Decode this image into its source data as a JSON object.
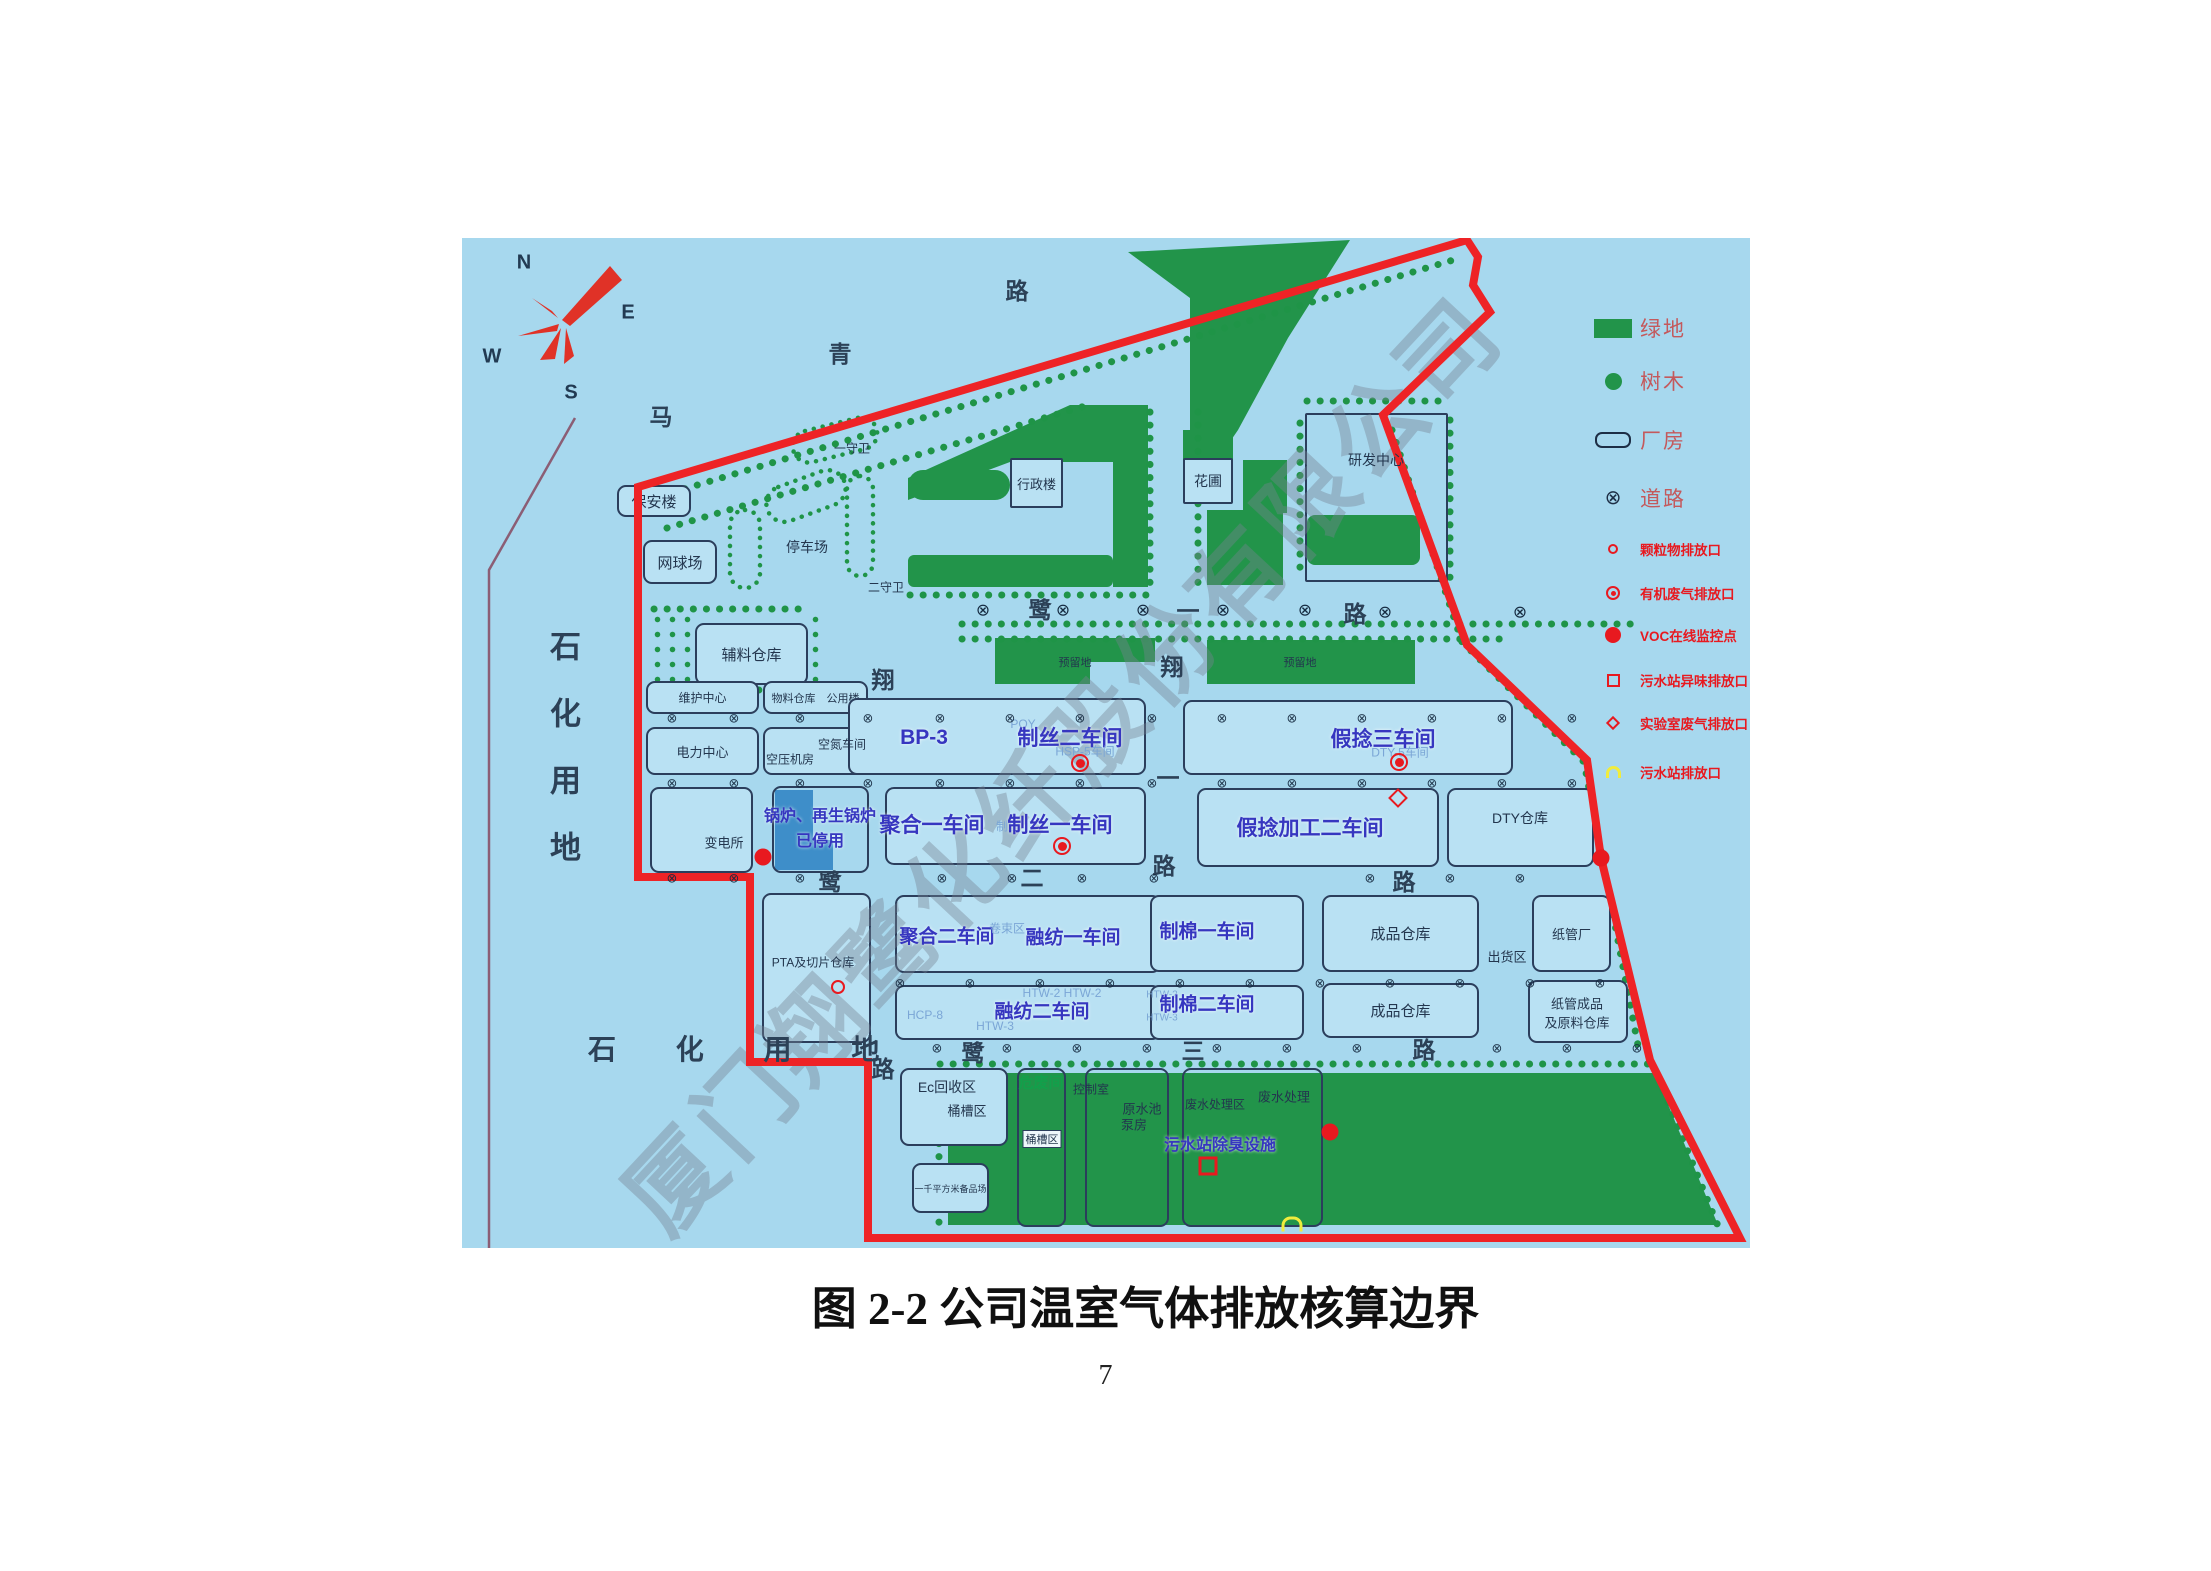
{
  "page": {
    "caption": "图 2-2 公司温室气体排放核算边界",
    "page_number": "7"
  },
  "map": {
    "watermark": "厦门翔鹭化纤股份有限公司",
    "compass": {
      "n": "N",
      "e": "E",
      "s": "S",
      "w": "W"
    },
    "land": {
      "vertical": "石化用地",
      "horizontal": "石 化 用 地"
    },
    "colors": {
      "map_bg": "#a7d8ee",
      "green": "#22944a",
      "boundary_red": "#ee2326",
      "workshop_blue": "#3636c0",
      "legend_pink": "#c4595c",
      "alert_red": "#e8191f",
      "stopped_boiler_blue": "#3e8ec9",
      "outline_navy": "#2b3e5c",
      "petro_line_purple": "#8b5e75"
    },
    "legend": {
      "items": [
        {
          "symbol": "green-area-swatch",
          "label": "绿地"
        },
        {
          "symbol": "tree-icon",
          "label": "树木"
        },
        {
          "symbol": "factory-building-icon",
          "label": "厂房"
        },
        {
          "symbol": "road-icon",
          "label": "道路"
        },
        {
          "symbol": "pm-outlet-icon",
          "label": "颗粒物排放口"
        },
        {
          "symbol": "organic-gas-outlet-icon",
          "label": "有机废气排放口"
        },
        {
          "symbol": "voc-monitor-icon",
          "label": "VOC在线监控点"
        },
        {
          "symbol": "sewage-odor-outlet-icon",
          "label": "污水站异味排放口"
        },
        {
          "symbol": "lab-gas-outlet-icon",
          "label": "实验室废气排放口"
        },
        {
          "symbol": "sewage-outlet-icon",
          "label": "污水站排放口"
        }
      ]
    },
    "labels": {
      "baoanlou": "保安楼",
      "wangqiuchang": "网球场",
      "tingchechang": "停车场",
      "yishouwei": "一守卫",
      "ershouwei": "二守卫",
      "fuliaocangku": "辅料仓库",
      "weihuzhongxin": "维护中心",
      "wuliao_gongyong": "物料仓库　公用楼",
      "dianlizhongxin": "电力中心",
      "kongyajifang": "空压机房",
      "kongdanchejian": "空氮车间",
      "biandiansuo": "变电所",
      "guolu_line1": "锅炉、再生锅炉",
      "guolu_line2": "已停用",
      "bp3": "BP-3",
      "poy": "POY",
      "zhisi2": "制丝二车间",
      "hsp5": "HSP-5车间",
      "jianian3": "假捻三车间",
      "dty5": "DTY-5车间",
      "juhe1": "聚合一车间",
      "zhisi_small": "制丝",
      "zhisi1": "制丝一车间",
      "jianianjiagong2": "假捻加工二车间",
      "dtycangku": "DTY仓库",
      "juhe2": "聚合二车间",
      "juanshuqu": "卷束区",
      "rongfang1": "融纺一车间",
      "zhimian1": "制棉一车间",
      "chengpincangku1": "成品仓库",
      "chuhuoqu": "出货区",
      "zhiguanchang": "纸管厂",
      "hcp8": "HCP-8",
      "htw2x2": "HTW-2  HTW-2",
      "htw3": "HTW-3",
      "rongfang2": "融纺二车间",
      "htw2b": "HTW-2",
      "htw3b": "HTW-3",
      "zhimian2": "制棉二车间",
      "chengpincangku2": "成品仓库",
      "zhiguan_line1": "纸管成品",
      "zhiguan_line2": "及原料仓库",
      "pta": "PTA及切片仓库",
      "ec": "Ec回收区",
      "tongcaoqu1": "桶槽区",
      "beipinchang": "一千平方米备品场",
      "weifeijian": "危废间",
      "tongcaoqu2": "桶槽区",
      "kongzhishi": "控制室",
      "yuanshuichi": "原水池",
      "bengfang": "泵房",
      "feishuichuliqu": "废水处理区",
      "feishuichuli": "废水处理",
      "wushuichuchou": "污水站除臭设施",
      "xingzhenglou": "行政楼",
      "huapu": "花圃",
      "yanfazhongxin": "研发中心",
      "yuliudi1": "预留地",
      "yuliudi2": "预留地"
    },
    "overlays": [
      {
        "cls": "rc",
        "n": "road-name-char",
        "t": "马",
        "x": 199,
        "y": 177
      },
      {
        "cls": "rc",
        "n": "road-name-char",
        "t": "青",
        "x": 378,
        "y": 114
      },
      {
        "cls": "rc",
        "n": "road-name-char",
        "t": "路",
        "x": 555,
        "y": 51
      },
      {
        "cls": "rc",
        "n": "road-name-char",
        "t": "鹭",
        "x": 578,
        "y": 370
      },
      {
        "cls": "rc",
        "n": "road-name-char",
        "t": "一",
        "x": 726,
        "y": 371
      },
      {
        "cls": "rc",
        "n": "road-name-char",
        "t": "路",
        "x": 893,
        "y": 374
      },
      {
        "cls": "rc",
        "n": "road-name-char",
        "t": "翔",
        "x": 421,
        "y": 440
      },
      {
        "cls": "rc",
        "n": "road-name-char",
        "t": "翔",
        "x": 710,
        "y": 427
      },
      {
        "cls": "rc",
        "n": "road-name-char",
        "t": "鹭",
        "x": 368,
        "y": 642
      },
      {
        "cls": "rc",
        "n": "road-name-char",
        "t": "二",
        "x": 570,
        "y": 638
      },
      {
        "cls": "rc",
        "n": "road-name-char",
        "t": "路",
        "x": 702,
        "y": 626
      },
      {
        "cls": "rc",
        "n": "road-name-char",
        "t": "路",
        "x": 942,
        "y": 642
      },
      {
        "cls": "rc",
        "n": "road-name-char",
        "t": "一",
        "x": 706,
        "y": 538
      },
      {
        "cls": "rc",
        "n": "road-name-char",
        "t": "鹭",
        "x": 511,
        "y": 813
      },
      {
        "cls": "rc",
        "n": "road-name-char",
        "t": "三",
        "x": 731,
        "y": 811
      },
      {
        "cls": "rc",
        "n": "road-name-char",
        "t": "路",
        "x": 962,
        "y": 810
      },
      {
        "cls": "rc",
        "n": "road-name-char",
        "t": "路",
        "x": 421,
        "y": 829
      },
      {
        "cls": "mk-roadx",
        "n": "road-crossing-icon",
        "t": "⊗",
        "x": 521,
        "y": 372
      },
      {
        "cls": "mk-roadx",
        "n": "road-crossing-icon",
        "t": "⊗",
        "x": 601,
        "y": 372
      },
      {
        "cls": "mk-roadx",
        "n": "road-crossing-icon",
        "t": "⊗",
        "x": 681,
        "y": 372
      },
      {
        "cls": "mk-roadx",
        "n": "road-crossing-icon",
        "t": "⊗",
        "x": 761,
        "y": 372
      },
      {
        "cls": "mk-roadx",
        "n": "road-crossing-icon",
        "t": "⊗",
        "x": 843,
        "y": 372
      },
      {
        "cls": "mk-roadx",
        "n": "road-crossing-icon",
        "t": "⊗",
        "x": 923,
        "y": 374
      },
      {
        "cls": "mk-roadx",
        "n": "road-crossing-icon",
        "t": "⊗",
        "x": 1058,
        "y": 374
      },
      {
        "cls": "mk-dot",
        "n": "road-node-icon",
        "t": "⊗",
        "x": 210,
        "y": 480
      },
      {
        "cls": "mk-dot",
        "n": "road-node-icon",
        "t": "⊗",
        "x": 272,
        "y": 480
      },
      {
        "cls": "mk-dot",
        "n": "road-node-icon",
        "t": "⊗",
        "x": 338,
        "y": 480
      },
      {
        "cls": "mk-dot",
        "n": "road-node-icon",
        "t": "⊗",
        "x": 406,
        "y": 480
      },
      {
        "cls": "mk-dot",
        "n": "road-node-icon",
        "t": "⊗",
        "x": 478,
        "y": 480
      },
      {
        "cls": "mk-dot",
        "n": "road-node-icon",
        "t": "⊗",
        "x": 548,
        "y": 480
      },
      {
        "cls": "mk-dot",
        "n": "road-node-icon",
        "t": "⊗",
        "x": 618,
        "y": 480
      },
      {
        "cls": "mk-dot",
        "n": "road-node-icon",
        "t": "⊗",
        "x": 690,
        "y": 480
      },
      {
        "cls": "mk-dot",
        "n": "road-node-icon",
        "t": "⊗",
        "x": 760,
        "y": 480
      },
      {
        "cls": "mk-dot",
        "n": "road-node-icon",
        "t": "⊗",
        "x": 830,
        "y": 480
      },
      {
        "cls": "mk-dot",
        "n": "road-node-icon",
        "t": "⊗",
        "x": 900,
        "y": 480
      },
      {
        "cls": "mk-dot",
        "n": "road-node-icon",
        "t": "⊗",
        "x": 970,
        "y": 480
      },
      {
        "cls": "mk-dot",
        "n": "road-node-icon",
        "t": "⊗",
        "x": 1040,
        "y": 480
      },
      {
        "cls": "mk-dot",
        "n": "road-node-icon",
        "t": "⊗",
        "x": 1110,
        "y": 480
      },
      {
        "cls": "mk-dot",
        "n": "road-node-icon",
        "t": "⊗",
        "x": 210,
        "y": 545
      },
      {
        "cls": "mk-dot",
        "n": "road-node-icon",
        "t": "⊗",
        "x": 272,
        "y": 545
      },
      {
        "cls": "mk-dot",
        "n": "road-node-icon",
        "t": "⊗",
        "x": 338,
        "y": 545
      },
      {
        "cls": "mk-dot",
        "n": "road-node-icon",
        "t": "⊗",
        "x": 406,
        "y": 545
      },
      {
        "cls": "mk-dot",
        "n": "road-node-icon",
        "t": "⊗",
        "x": 478,
        "y": 545
      },
      {
        "cls": "mk-dot",
        "n": "road-node-icon",
        "t": "⊗",
        "x": 548,
        "y": 545
      },
      {
        "cls": "mk-dot",
        "n": "road-node-icon",
        "t": "⊗",
        "x": 618,
        "y": 545
      },
      {
        "cls": "mk-dot",
        "n": "road-node-icon",
        "t": "⊗",
        "x": 690,
        "y": 545
      },
      {
        "cls": "mk-dot",
        "n": "road-node-icon",
        "t": "⊗",
        "x": 760,
        "y": 545
      },
      {
        "cls": "mk-dot",
        "n": "road-node-icon",
        "t": "⊗",
        "x": 830,
        "y": 545
      },
      {
        "cls": "mk-dot",
        "n": "road-node-icon",
        "t": "⊗",
        "x": 900,
        "y": 545
      },
      {
        "cls": "mk-dot",
        "n": "road-node-icon",
        "t": "⊗",
        "x": 970,
        "y": 545
      },
      {
        "cls": "mk-dot",
        "n": "road-node-icon",
        "t": "⊗",
        "x": 1040,
        "y": 545
      },
      {
        "cls": "mk-dot",
        "n": "road-node-icon",
        "t": "⊗",
        "x": 1110,
        "y": 545
      },
      {
        "cls": "mk-dot",
        "n": "road-node-icon",
        "t": "⊗",
        "x": 210,
        "y": 640
      },
      {
        "cls": "mk-dot",
        "n": "road-node-icon",
        "t": "⊗",
        "x": 272,
        "y": 640
      },
      {
        "cls": "mk-dot",
        "n": "road-node-icon",
        "t": "⊗",
        "x": 338,
        "y": 640
      },
      {
        "cls": "mk-dot",
        "n": "road-node-icon",
        "t": "⊗",
        "x": 480,
        "y": 640
      },
      {
        "cls": "mk-dot",
        "n": "road-node-icon",
        "t": "⊗",
        "x": 550,
        "y": 640
      },
      {
        "cls": "mk-dot",
        "n": "road-node-icon",
        "t": "⊗",
        "x": 620,
        "y": 640
      },
      {
        "cls": "mk-dot",
        "n": "road-node-icon",
        "t": "⊗",
        "x": 692,
        "y": 640
      },
      {
        "cls": "mk-dot",
        "n": "road-node-icon",
        "t": "⊗",
        "x": 908,
        "y": 640
      },
      {
        "cls": "mk-dot",
        "n": "road-node-icon",
        "t": "⊗",
        "x": 988,
        "y": 640
      },
      {
        "cls": "mk-dot",
        "n": "road-node-icon",
        "t": "⊗",
        "x": 1058,
        "y": 640
      },
      {
        "cls": "mk-dot",
        "n": "road-node-icon",
        "t": "⊗",
        "x": 438,
        "y": 745
      },
      {
        "cls": "mk-dot",
        "n": "road-node-icon",
        "t": "⊗",
        "x": 508,
        "y": 745
      },
      {
        "cls": "mk-dot",
        "n": "road-node-icon",
        "t": "⊗",
        "x": 578,
        "y": 745
      },
      {
        "cls": "mk-dot",
        "n": "road-node-icon",
        "t": "⊗",
        "x": 648,
        "y": 745
      },
      {
        "cls": "mk-dot",
        "n": "road-node-icon",
        "t": "⊗",
        "x": 718,
        "y": 745
      },
      {
        "cls": "mk-dot",
        "n": "road-node-icon",
        "t": "⊗",
        "x": 788,
        "y": 745
      },
      {
        "cls": "mk-dot",
        "n": "road-node-icon",
        "t": "⊗",
        "x": 858,
        "y": 745
      },
      {
        "cls": "mk-dot",
        "n": "road-node-icon",
        "t": "⊗",
        "x": 928,
        "y": 745
      },
      {
        "cls": "mk-dot",
        "n": "road-node-icon",
        "t": "⊗",
        "x": 998,
        "y": 745
      },
      {
        "cls": "mk-dot",
        "n": "road-node-icon",
        "t": "⊗",
        "x": 1068,
        "y": 745
      },
      {
        "cls": "mk-dot",
        "n": "road-node-icon",
        "t": "⊗",
        "x": 1138,
        "y": 745
      },
      {
        "cls": "mk-dot",
        "n": "road-node-icon",
        "t": "⊗",
        "x": 475,
        "y": 810
      },
      {
        "cls": "mk-dot",
        "n": "road-node-icon",
        "t": "⊗",
        "x": 545,
        "y": 810
      },
      {
        "cls": "mk-dot",
        "n": "road-node-icon",
        "t": "⊗",
        "x": 615,
        "y": 810
      },
      {
        "cls": "mk-dot",
        "n": "road-node-icon",
        "t": "⊗",
        "x": 685,
        "y": 810
      },
      {
        "cls": "mk-dot",
        "n": "road-node-icon",
        "t": "⊗",
        "x": 755,
        "y": 810
      },
      {
        "cls": "mk-dot",
        "n": "road-node-icon",
        "t": "⊗",
        "x": 825,
        "y": 810
      },
      {
        "cls": "mk-dot",
        "n": "road-node-icon",
        "t": "⊗",
        "x": 895,
        "y": 810
      },
      {
        "cls": "mk-dot",
        "n": "road-node-icon",
        "t": "⊗",
        "x": 1035,
        "y": 810
      },
      {
        "cls": "mk-dot",
        "n": "road-node-icon",
        "t": "⊗",
        "x": 1105,
        "y": 810
      },
      {
        "cls": "mk-dot",
        "n": "road-node-icon",
        "t": "⊗",
        "x": 1175,
        "y": 810
      },
      {
        "cls": "mk-pm",
        "n": "pm-outlet-icon",
        "x": 376,
        "y": 749
      },
      {
        "cls": "mk-org",
        "n": "organic-gas-outlet-icon",
        "x": 618,
        "y": 525
      },
      {
        "cls": "mk-org",
        "n": "organic-gas-outlet-icon",
        "x": 600,
        "y": 608
      },
      {
        "cls": "mk-org",
        "n": "organic-gas-outlet-icon",
        "x": 937,
        "y": 524
      },
      {
        "cls": "mk-voc",
        "n": "voc-monitor-icon",
        "x": 301,
        "y": 619
      },
      {
        "cls": "mk-voc",
        "n": "voc-monitor-icon",
        "x": 1139,
        "y": 620
      },
      {
        "cls": "mk-voc",
        "n": "voc-monitor-icon",
        "x": 868,
        "y": 894
      },
      {
        "cls": "mk-sq",
        "n": "sewage-odor-outlet-icon",
        "x": 746,
        "y": 928
      },
      {
        "cls": "mk-dia",
        "n": "lab-gas-outlet-icon",
        "x": 936,
        "y": 560
      },
      {
        "cls": "mk-yel",
        "n": "sewage-outlet-icon",
        "x": 830,
        "y": 986
      }
    ]
  }
}
